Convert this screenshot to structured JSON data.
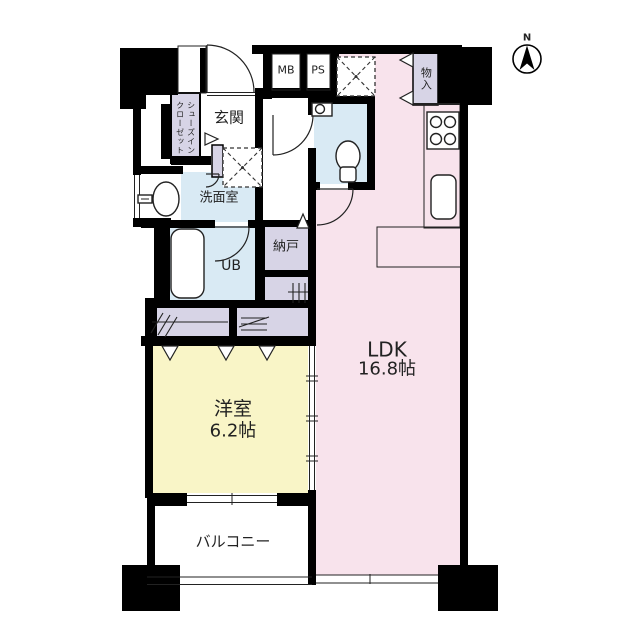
{
  "compass": {
    "label": "N"
  },
  "rooms": {
    "ldk": {
      "name": "LDK",
      "size": "16.8帖"
    },
    "western_room": {
      "name": "洋室",
      "size": "6.2帖"
    },
    "balcony": {
      "name": "バルコニー"
    },
    "entrance": {
      "name": "玄関"
    },
    "shoes_closet": {
      "line1": "シューズイン",
      "line2": "クローゼット"
    },
    "washroom": {
      "name": "洗面室"
    },
    "unit_bath": {
      "name": "UB"
    },
    "storage_nando": {
      "name": "納戸"
    },
    "meter_box": {
      "name": "MB"
    },
    "pipe_space": {
      "name": "PS"
    },
    "storage_monoire": {
      "name": "物入"
    }
  },
  "icons": {
    "compass": "compass-north-arrow",
    "toilet": "toilet",
    "bathtub": "bathtub",
    "stove": "four-burner-stove",
    "kitchen_sink": "kitchen-sink",
    "washbasin": "washbasin",
    "washer_pan": "washing-machine-space",
    "fridge_space": "refrigerator-space"
  },
  "colors": {
    "ldk": "#f8e3ec",
    "western_room": "#f9f5c7",
    "wet_area": "#d9eaf4",
    "storage": "#d7d4e6",
    "wall": "#000000"
  }
}
